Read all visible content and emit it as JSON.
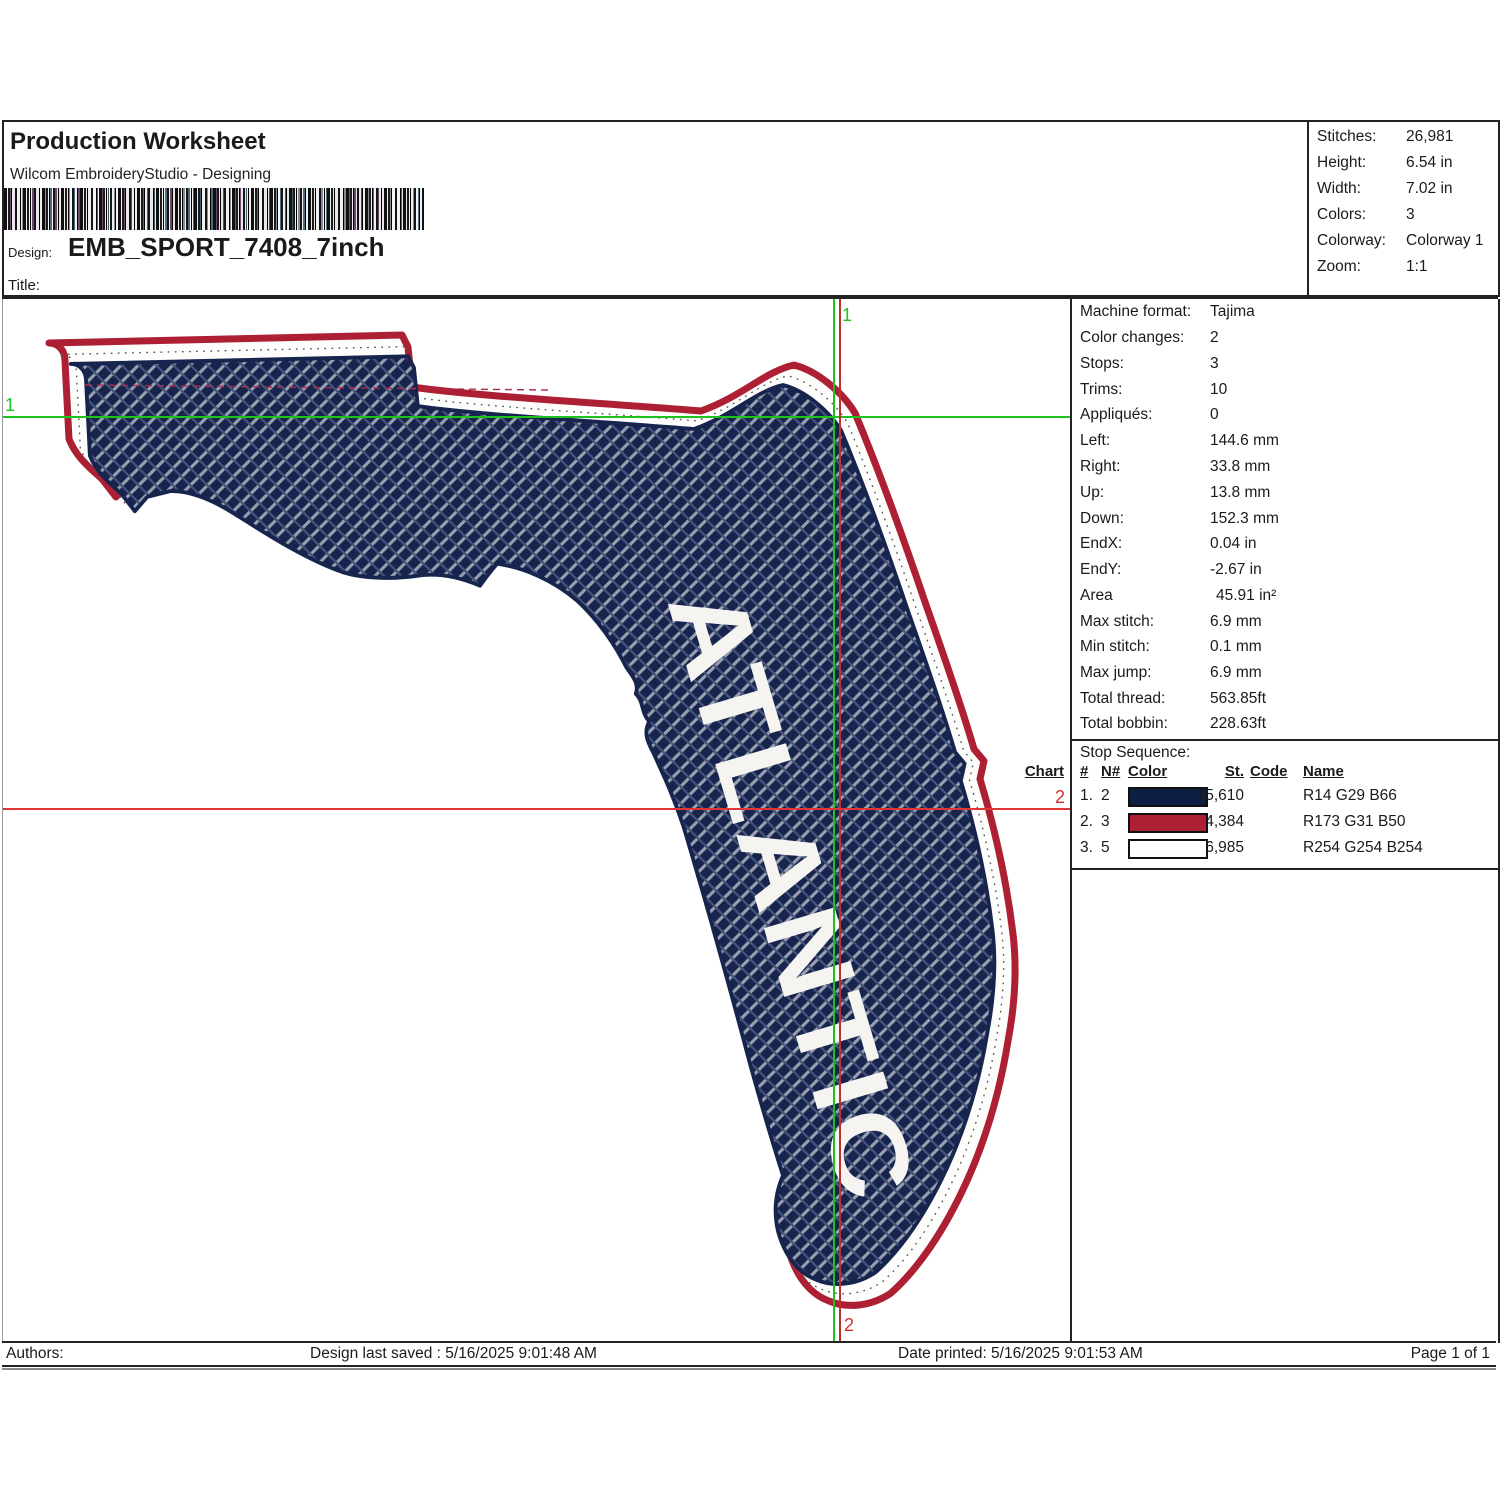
{
  "header": {
    "title": "Production Worksheet",
    "subtitle": "Wilcom EmbroideryStudio - Designing",
    "design_label": "Design:",
    "design_value": "EMB_SPORT_7408_7inch",
    "title_label": "Title:"
  },
  "stats": {
    "rows": [
      {
        "label": "Stitches:",
        "value": "26,981"
      },
      {
        "label": "Height:",
        "value": "6.54 in"
      },
      {
        "label": "Width:",
        "value": "7.02 in"
      },
      {
        "label": "Colors:",
        "value": "3"
      },
      {
        "label": "Colorway:",
        "value": "Colorway 1"
      },
      {
        "label": "Zoom:",
        "value": "1:1"
      }
    ]
  },
  "machine_info": {
    "rows": [
      {
        "label": "Machine format:",
        "value": "Tajima"
      },
      {
        "label": "Color changes:",
        "value": "2"
      },
      {
        "label": "Stops:",
        "value": "3"
      },
      {
        "label": "Trims:",
        "value": "10"
      },
      {
        "label": "Appliqués:",
        "value": "0"
      },
      {
        "label": "Left:",
        "value": "144.6 mm"
      },
      {
        "label": "Right:",
        "value": "33.8 mm"
      },
      {
        "label": "Up:",
        "value": "13.8 mm"
      },
      {
        "label": "Down:",
        "value": "152.3 mm"
      },
      {
        "label": "EndX:",
        "value": "0.04 in"
      },
      {
        "label": "EndY:",
        "value": "-2.67 in"
      },
      {
        "label": "Area",
        "value": "45.91 in²"
      },
      {
        "label": "Max stitch:",
        "value": "6.9 mm"
      },
      {
        "label": "Min stitch:",
        "value": "0.1 mm"
      },
      {
        "label": "Max jump:",
        "value": "6.9 mm"
      },
      {
        "label": "Total thread:",
        "value": "563.85ft"
      },
      {
        "label": "Total bobbin:",
        "value": "228.63ft"
      }
    ]
  },
  "stop_sequence": {
    "title": "Stop Sequence:",
    "columns": {
      "num": "#",
      "n": "N#",
      "color": "Color",
      "st": "St.",
      "code": "Code",
      "name": "Name",
      "chart": "Chart"
    },
    "rows": [
      {
        "num": "1.",
        "n": "2",
        "swatch": "#0E1D42",
        "st": "15,610",
        "code": "",
        "name": "R14 G29 B66",
        "chart": ""
      },
      {
        "num": "2.",
        "n": "3",
        "swatch": "#AD1F32",
        "st": "4,384",
        "code": "",
        "name": "R173 G31 B50",
        "chart": ""
      },
      {
        "num": "3.",
        "n": "5",
        "swatch": "#FEFEFE",
        "st": "6,985",
        "code": "",
        "name": "R254 G254 B254",
        "chart": ""
      }
    ]
  },
  "design": {
    "text": "ATLANTIC",
    "marker_start": "1",
    "marker_end": "2",
    "colors": {
      "fill_navy": "#0E1D42",
      "border_red": "#AD1F32",
      "gap_white": "#FEFEFE",
      "hatch_gray": "#939CAD",
      "start_line_green": "#1DC31D",
      "end_line_red": "#E03535"
    }
  },
  "footer": {
    "authors_label": "Authors:",
    "design_saved": "Design last saved : 5/16/2025 9:01:48 AM",
    "date_printed": "Date printed: 5/16/2025 9:01:53 AM",
    "page": "Page 1 of 1"
  }
}
